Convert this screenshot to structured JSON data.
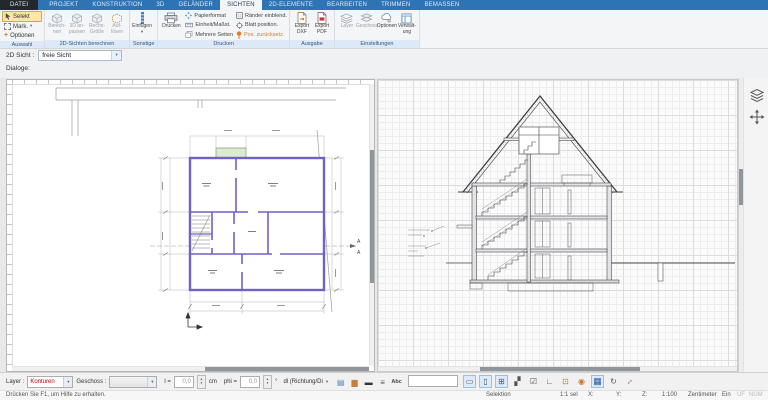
{
  "ribbon": {
    "tabs": [
      {
        "label": "DATEI"
      },
      {
        "label": "PROJEKT"
      },
      {
        "label": "KONSTRUKTION"
      },
      {
        "label": "3D"
      },
      {
        "label": "GELÄNDER"
      },
      {
        "label": "SICHTEN"
      },
      {
        "label": "2D-ELEMENTE"
      },
      {
        "label": "BEARBEITEN"
      },
      {
        "label": "TRIMMEN"
      },
      {
        "label": "BEMASSEN"
      }
    ],
    "groups": [
      {
        "label": "Auswahl"
      },
      {
        "label": "2D-Sichten berechnen"
      },
      {
        "label": "Sonstige"
      },
      {
        "label": "Drucken"
      },
      {
        "label": "Ausgabe"
      },
      {
        "label": "Einstellungen"
      }
    ],
    "auswahl": {
      "selekt": "Selekt",
      "mark": "Mark.",
      "optionen": "Optionen"
    },
    "berechnen": {
      "b1": "Berech-\nnen",
      "b2": "3D an-\npassen",
      "b3": "Rechn-\nGröße",
      "b4": "Auf-\nlösen"
    },
    "sonstige": {
      "einfuegen": "Einfügen"
    },
    "drucken": {
      "drucken": "Drucken",
      "papierformat": "Papierformat",
      "einheit": "Einheit/Maßst.",
      "mehrere": "Mehrere Seiten",
      "raender": "Ränder einblend.",
      "blatt": "Blatt position.",
      "pos": "Pos. zurücksetz."
    },
    "ausgabe": {
      "dxf": "Export\nDXF",
      "pdf": "Export\nPDF"
    },
    "einstellungen": {
      "layer": "Layer",
      "geschoss": "Geschoss",
      "optionen": "Optionen",
      "verwaltung": "Verwalt-\nung"
    }
  },
  "viewbar": {
    "label": "2D Sicht :",
    "value": "freie Sicht"
  },
  "dialoge_label": "Dialoge:",
  "plan_view": {
    "section_marker": "A"
  },
  "bottom_toolbar": {
    "layer_label": "Layer :",
    "layer_value": "Konturen",
    "geschoss_label": "Geschoss :",
    "l_label": "l =",
    "l_value": "0,0",
    "l_unit": "cm",
    "phi_label": "phi =",
    "phi_value": "0,0",
    "phi_unit": "°",
    "dl_label": "dl (Richtung/Di"
  },
  "statusbar": {
    "help": "Drücken Sie F1, um Hilfe zu erhalten.",
    "selection": "Selektion",
    "scale_sel": "1:1 sel",
    "x": "X:",
    "y": "Y:",
    "z": "Z:",
    "scale": "1:100",
    "unit": "Zentimeter",
    "ein": "Ein",
    "uf": "UF",
    "num": "NUM"
  },
  "icons": {
    "chevron_down": "▾",
    "plus": "+",
    "spin_up": "▴",
    "spin_down": "▾",
    "cursor_bar": "|",
    "group1": [
      "▤",
      "▆",
      "▬",
      "≡",
      "Abc",
      "∴",
      "○",
      "□"
    ],
    "group2": [
      "▭",
      "▯",
      "⊞",
      "▞",
      "☑",
      "∟",
      "⊡",
      "◉",
      "▦",
      "↻",
      "↕"
    ]
  },
  "colors": {
    "accent_blue": "#2e74b5",
    "selection_orange": "#dca73f",
    "layer_red": "#c00000",
    "wall_purple": "#6f61c6"
  }
}
